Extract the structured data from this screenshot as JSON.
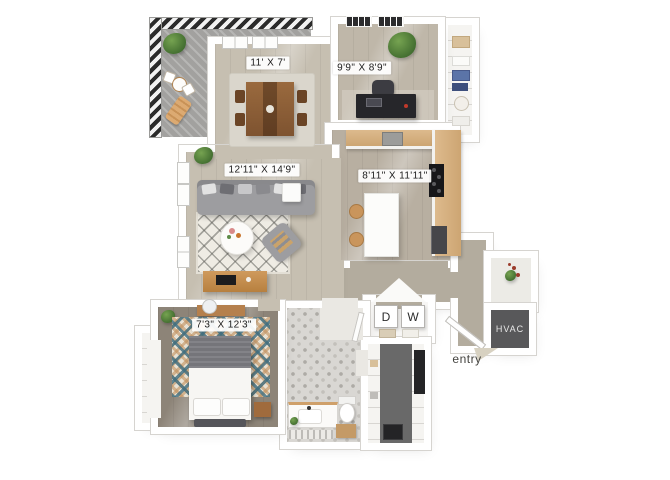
{
  "plan": {
    "rooms": {
      "dining": {
        "label": "11' X 7'"
      },
      "den": {
        "label": "9'9\" X 8'9\""
      },
      "living": {
        "label": "12'11\" X 14'9\""
      },
      "kitchen": {
        "label": "8'11\" X 11'11\""
      },
      "bedroom": {
        "label": "7'3\" X 12'3\""
      }
    },
    "appliances": {
      "dryer": "D",
      "washer": "W",
      "hvac": "HVAC"
    },
    "annotations": {
      "entry": "entry"
    }
  },
  "colors": {
    "wall": "#ffffff",
    "wall_edge": "#d6d4d0",
    "floor_main": "#c6bfb1",
    "floor_kitchen": "#b8afa1",
    "floor_office": "#bfb7a9",
    "floor_bedroom": "#8d8478",
    "floor_entry": "#b3ac9e",
    "floor_walk_in": "#696969",
    "bath_tile": "#d9d7d3",
    "deck": "#a2a19f",
    "railing_dark": "#2b2b2b",
    "counter_wood": "#ddba8d",
    "furniture_wood": "#c08b50",
    "sofa_grey": "#9d9da0",
    "hvac_bg": "#58585a",
    "plant_green": "#3f6a2e",
    "label_text": "#1b1b1b"
  }
}
